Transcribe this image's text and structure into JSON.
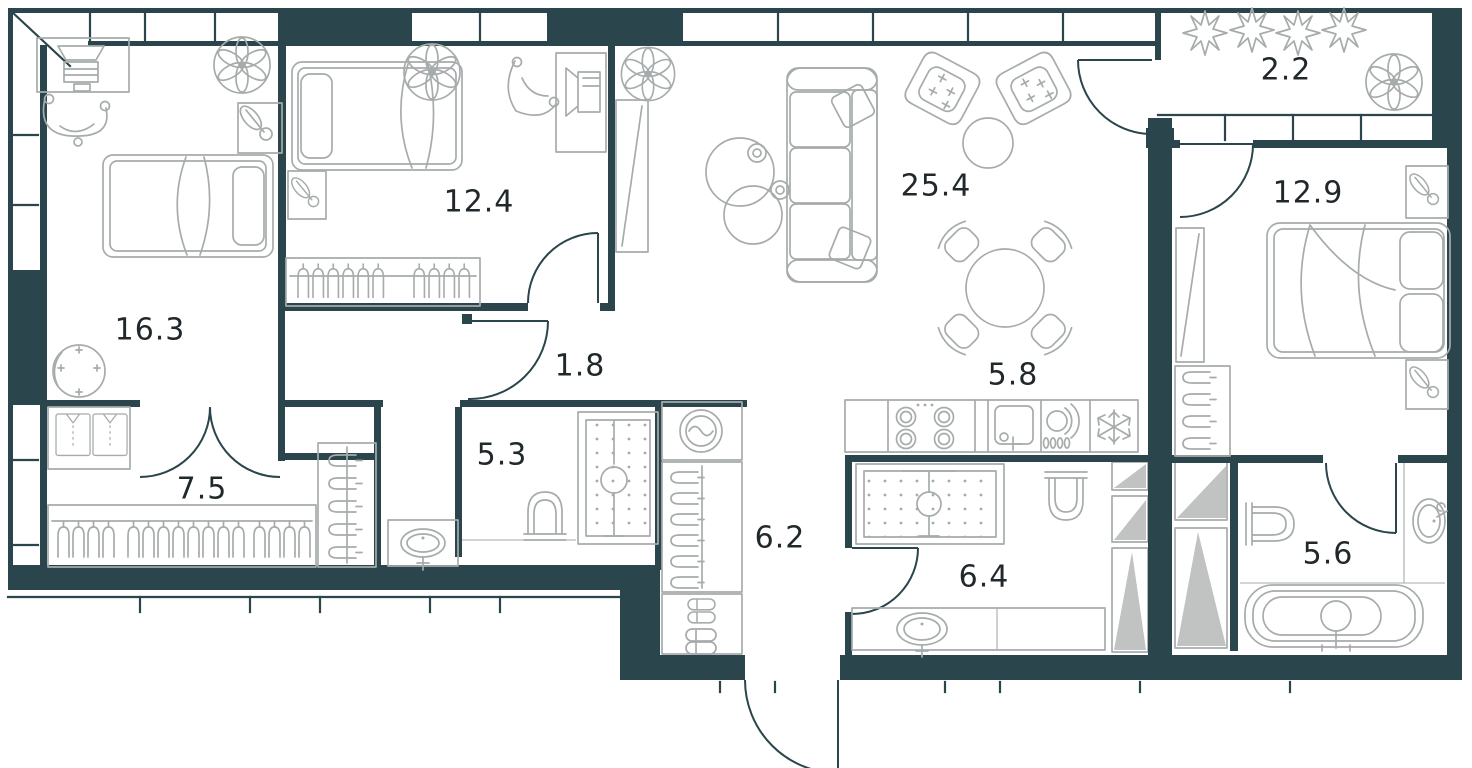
{
  "plan": {
    "type": "apartment-floor-plan",
    "colors": {
      "wall": "#2a454b",
      "furniture": "#a6abab",
      "hatch": "#b9bcbb",
      "label": "#20282b",
      "background": "#ffffff"
    },
    "rooms": [
      {
        "id": "bedroom-left",
        "area": "16.3"
      },
      {
        "id": "bedroom-top",
        "area": "12.4"
      },
      {
        "id": "vestibule",
        "area": "1.8"
      },
      {
        "id": "corridor",
        "area": "7.5"
      },
      {
        "id": "bathroom-inner",
        "area": "5.3"
      },
      {
        "id": "entry-hall",
        "area": "6.2"
      },
      {
        "id": "living-room",
        "area": "25.4"
      },
      {
        "id": "kitchen",
        "area": "5.8"
      },
      {
        "id": "bathroom-entry",
        "area": "6.4"
      },
      {
        "id": "balcony",
        "area": "2.2"
      },
      {
        "id": "bedroom-right",
        "area": "12.9"
      },
      {
        "id": "bathroom-right",
        "area": "5.6"
      }
    ],
    "furniture_icons": [
      "bed-icon",
      "pillow-icon",
      "desk-icon",
      "computer-icon",
      "office-chair-icon",
      "plant-icon",
      "flower-icon",
      "wardrobe-hangers-icon",
      "shirt-wardrobe-icon",
      "mirror-wardrobe-icon",
      "round-mirror-icon",
      "sofa-icon",
      "armchair-icon",
      "coffee-table-icon",
      "side-table-icon",
      "dining-table-icon",
      "dining-chair-icon",
      "cooktop-icon",
      "kitchen-sink-icon",
      "dishwasher-icon",
      "fridge-snowflake-icon",
      "washing-machine-icon",
      "shoe-shelf-icon",
      "shower-icon",
      "toilet-icon",
      "washbasin-icon",
      "bathtub-icon",
      "door-arc-icon",
      "window-band-icon",
      "shaft-hatch-icon",
      "bloom-icon"
    ]
  }
}
